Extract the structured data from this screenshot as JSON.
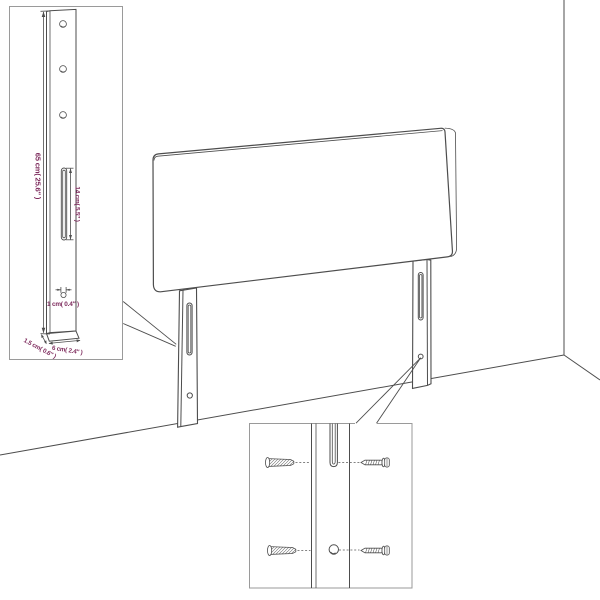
{
  "diagram_type": "furniture assembly diagram",
  "product": "upholstered headboard with two slotted mounting legs, shown in a room corner",
  "colors": {
    "line": "#4d4d4d",
    "inset_border": "#9a9a9a",
    "dimension_text": "#7d2a5c",
    "background": "#ffffff"
  },
  "insets": {
    "leg_dimensions": {
      "height_label": "65 cm( 25.6″ )",
      "slot_label": "14 cm( 5.5″ )",
      "hole_label": "1 cm( 0.4″ )",
      "depth_label": "1.5 cm( 0.6″ )",
      "width_label": "6 cm( 2.4″ )"
    },
    "mounting_detail": {
      "hardware": [
        "wall-plug",
        "screw",
        "wall-plug",
        "screw"
      ]
    }
  }
}
